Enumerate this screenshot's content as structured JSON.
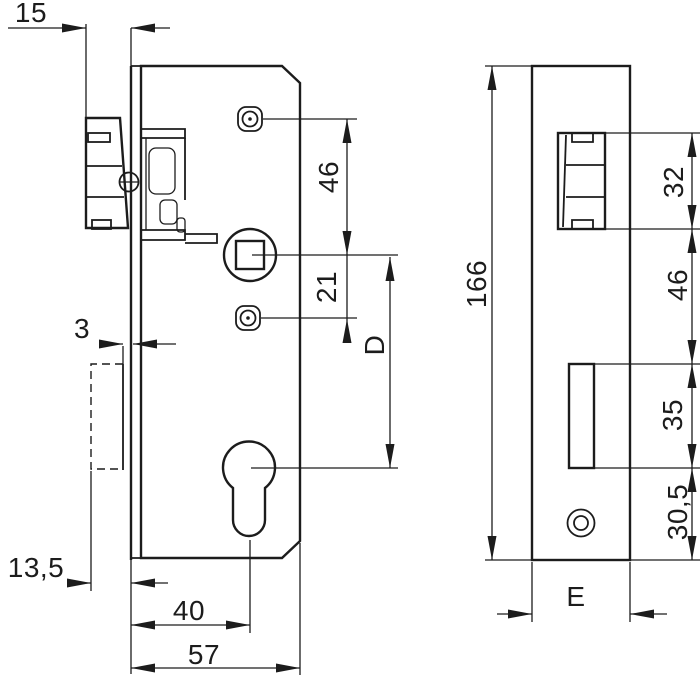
{
  "title": "Mortise lock technical drawing",
  "units": "mm",
  "colors": {
    "line": "#1c1c1c",
    "background": "#ffffff"
  },
  "views": {
    "side_view": "lock case side view",
    "front_view": "faceplate front view"
  },
  "dimensions": {
    "latch_projection": "15",
    "screw_to_spindle": "46",
    "spindle_to_lower_screw": "21",
    "spindle_to_cylinder": "D",
    "deadbolt_retracted_projection": "3",
    "deadbolt_extended_projection": "13,5",
    "backset": "40",
    "case_depth": "57",
    "faceplate_length": "166",
    "latch_cutout_height": "32",
    "latch_to_deadbolt_cutout": "46",
    "deadbolt_cutout_height": "35",
    "deadbolt_cutout_to_end": "30,5",
    "faceplate_width": "E"
  }
}
